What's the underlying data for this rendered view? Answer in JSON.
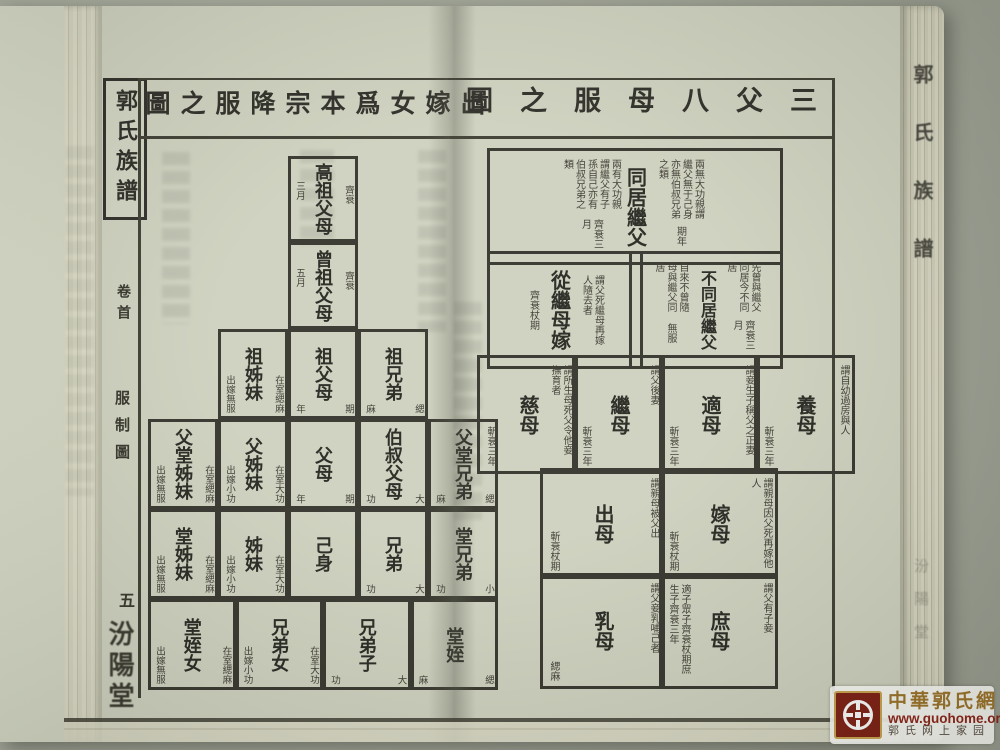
{
  "book": {
    "spine_title": "郭氏族譜",
    "spine_hall": "汾陽堂"
  },
  "left_page": {
    "margin": {
      "book_label": "郭氏族譜",
      "volume": "卷首",
      "section": "服制圖",
      "page_number": "五",
      "hall": "汾陽堂"
    },
    "title": "出嫁女爲本宗降服之圖",
    "rows": [
      {
        "cells": [
          {
            "label": "高祖父母",
            "note_r": "齊衰",
            "note_l": "三月"
          }
        ]
      },
      {
        "cells": [
          {
            "label": "曾祖父母",
            "note_r": "齊衰",
            "note_l": "五月"
          }
        ]
      },
      {
        "cells": [
          {
            "label": "祖姊妹",
            "note_r": "在室緦麻",
            "note_l": "出嫁無服"
          },
          {
            "label": "祖父母",
            "note_r": "期",
            "note_l": "年"
          },
          {
            "label": "祖兄弟",
            "note_r": "緦",
            "note_l": "麻"
          }
        ]
      },
      {
        "cells": [
          {
            "label": "父堂姊妹",
            "note_r": "在室緦麻",
            "note_l": "出嫁無服"
          },
          {
            "label": "父姊妹",
            "note_r": "在室大功",
            "note_l": "出嫁小功"
          },
          {
            "label": "父母",
            "note_r": "期",
            "note_l": "年"
          },
          {
            "label": "伯叔父母",
            "note_r": "大",
            "note_l": "功"
          },
          {
            "label": "父堂兄弟",
            "note_r": "緦",
            "note_l": "麻"
          }
        ]
      },
      {
        "cells": [
          {
            "label": "堂姊妹",
            "note_r": "在室緦麻",
            "note_l": "出嫁無服"
          },
          {
            "label": "姊妹",
            "note_r": "在室大功",
            "note_l": "出嫁小功"
          },
          {
            "label": "己身",
            "note_r": "",
            "note_l": ""
          },
          {
            "label": "兄弟",
            "note_r": "大",
            "note_l": "功"
          },
          {
            "label": "堂兄弟",
            "note_r": "小",
            "note_l": "功"
          }
        ]
      },
      {
        "cells": [
          {
            "label": "堂姪女",
            "note_r": "在室緦麻",
            "note_l": "出嫁無服"
          },
          {
            "label": "兄弟女",
            "note_r": "在室大功",
            "note_l": "出嫁小功"
          },
          {
            "label": "兄弟子",
            "note_r": "大",
            "note_l": "功"
          },
          {
            "label": "堂姪",
            "note_r": "緦",
            "note_l": "麻"
          }
        ]
      }
    ]
  },
  "right_page": {
    "title": "三父八母服之圖",
    "cells": {
      "tongju": {
        "label": "同居繼父",
        "right_note": "兩無大功親謂繼父無于己身亦無伯叔兄弟之類",
        "right_grade": "期年",
        "left_note": "兩有大功親謂繼父有子孫自己亦有伯叔兄弟之類",
        "left_grade": "齊衰三月"
      },
      "congjimu": {
        "label": "從繼母嫁",
        "note": "謂父死繼母再嫁人隨去者",
        "grade": "齊衰杖期"
      },
      "butongju": {
        "label": "不同居繼父",
        "right_note": "先曾與繼父同居今不同居",
        "right_grade": "齊衰三月",
        "left_note": "自來不曾隨母與繼父同居",
        "left_grade": "無服"
      },
      "cimu": {
        "label": "慈母",
        "note": "謂所生母死父令他妾撫育者",
        "grade": "斬衰三年"
      },
      "jimu": {
        "label": "繼母",
        "note": "謂父後妻",
        "grade": "斬衰三年"
      },
      "dimu": {
        "label": "適母",
        "note": "謂妾生子稱父之正妻",
        "grade": "斬衰三年"
      },
      "yangmu": {
        "label": "養母",
        "note": "謂自幼過房與人",
        "grade": "斬衰三年"
      },
      "chumu": {
        "label": "出母",
        "note": "謂親母被父出",
        "grade": "斬衰杖期"
      },
      "jiamu": {
        "label": "嫁母",
        "note": "謂親母因父死再嫁他人",
        "grade": "斬衰杖期"
      },
      "rumu": {
        "label": "乳母",
        "note": "謂父妾乳哺己者",
        "grade": "緦麻"
      },
      "shumu": {
        "label": "庶母",
        "note": "謂父有子妾",
        "grade": "適子眾子齊衰杖期庶生子齊衰三年"
      }
    }
  },
  "watermark": {
    "site_name": "中華郭氏網",
    "url": "www.guohome.org",
    "tagline": "郭氏网上家园"
  }
}
